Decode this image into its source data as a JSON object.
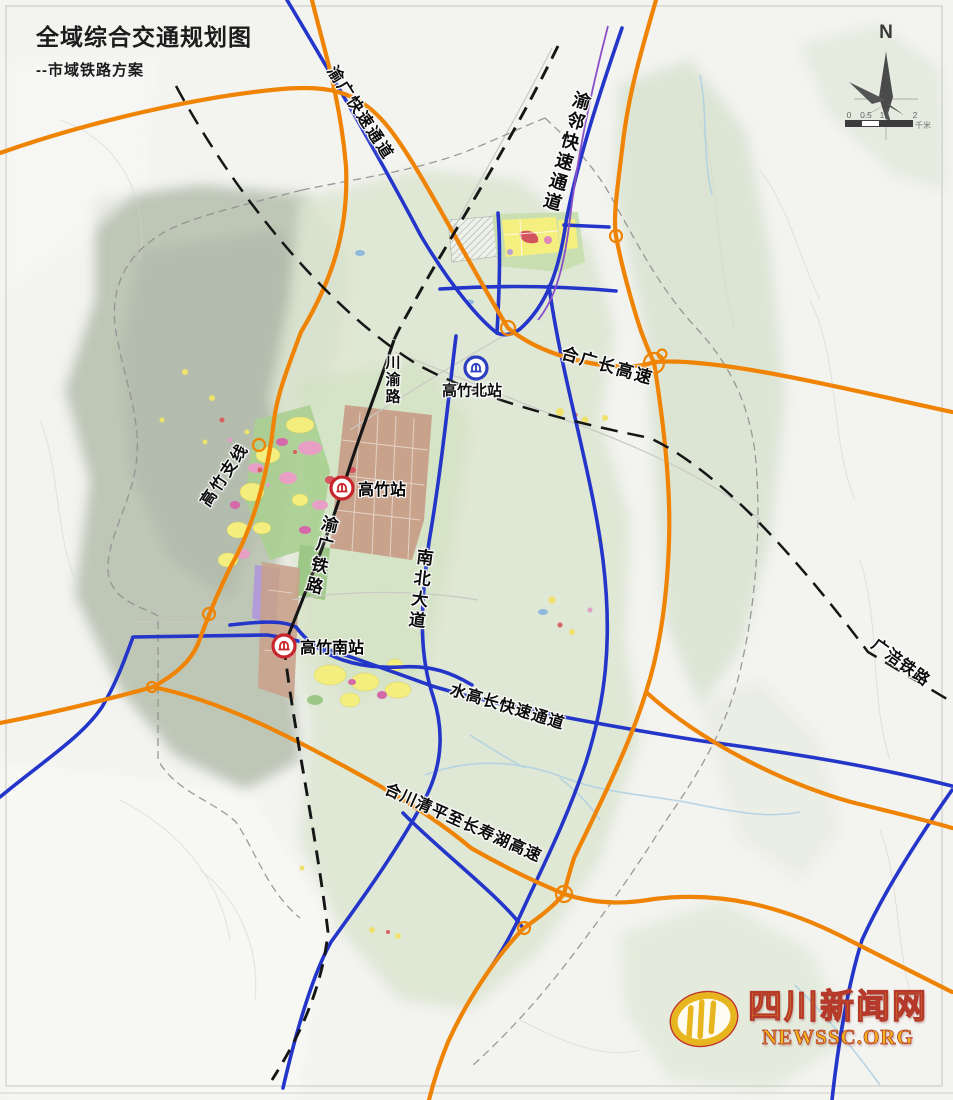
{
  "title": {
    "main": "全域综合交通规划图",
    "subtitle": "--市域铁路方案"
  },
  "labels": {
    "yuguang_expressway": "渝广快速通道",
    "yulin_expressway": "渝邻快速通道",
    "heguangchang_expressway": "合广长高速",
    "chuanyu_road": "川渝路",
    "gaozhu_branch": "高竹支线",
    "yuguang_railway": "渝广铁路",
    "nanbei_avenue": "南北大道",
    "guangfu_railway": "广涪铁路",
    "shuigaochang_expressway": "水高长快速通道",
    "hechuan_changshou_expressway": "合川清平至长寿湖高速"
  },
  "stations": {
    "north": "高竹北站",
    "main": "高竹站",
    "south": "高竹南站"
  },
  "compass": {
    "north_label": "N"
  },
  "scalebar": {
    "tick0": "0",
    "tick05": "0.5",
    "tick1": "1",
    "tick2": "2",
    "unit": "千米"
  },
  "logo": {
    "site_name": "四川新闻网",
    "site_url": "NEWSSC.ORG"
  },
  "colors": {
    "expressway_orange": "#ef8303",
    "arterial_blue": "#2336c9",
    "railway_black": "#161616",
    "transit_purple": "#8a4fc8",
    "station_red": "#c8252c",
    "station_blue": "#2b3fc0",
    "boundary_grey": "#8f8f8f"
  }
}
